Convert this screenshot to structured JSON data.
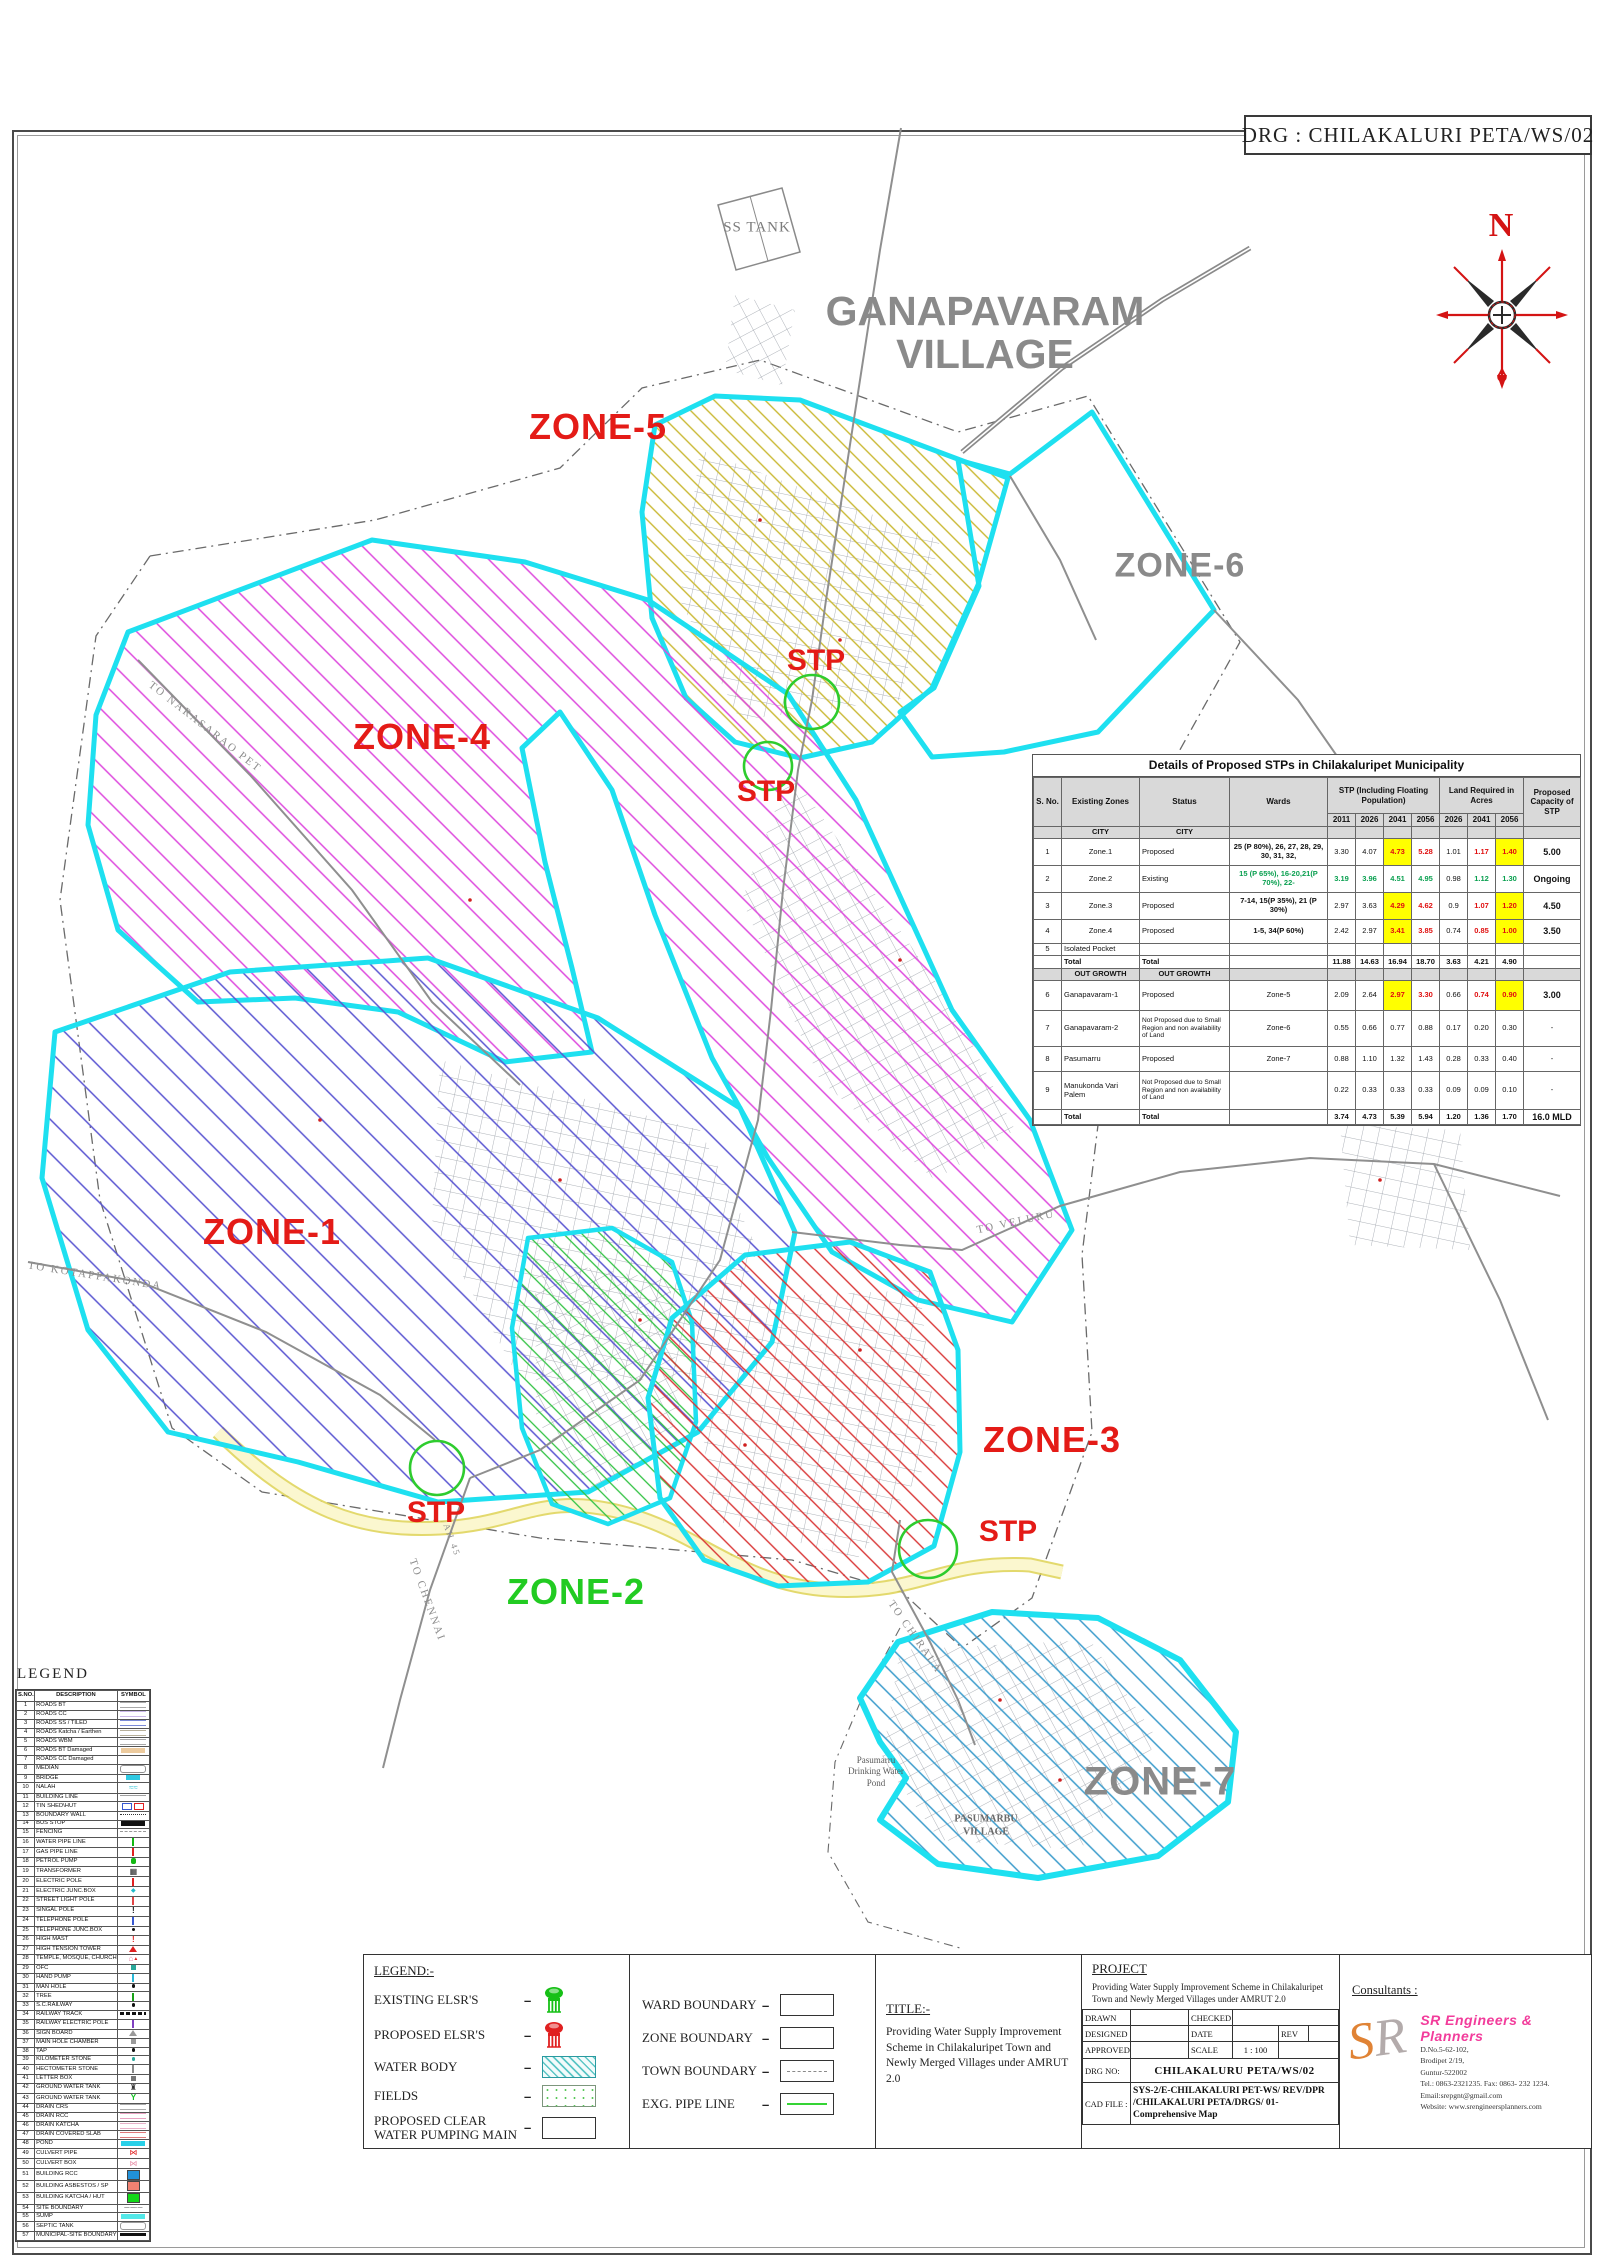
{
  "sheet": {
    "drg_title": "DRG : CHILAKALURI PETA/WS/02",
    "compass_n": "N"
  },
  "map": {
    "labels": {
      "ganapavaram_line1": "GANAPAVARAM",
      "ganapavaram_line2": "VILLAGE",
      "ss_tank": "SS TANK",
      "zone1": "ZONE-1",
      "zone2": "ZONE-2",
      "zone3": "ZONE-3",
      "zone4": "ZONE-4",
      "zone5": "ZONE-5",
      "zone6": "ZONE-6",
      "zone7": "ZONE-7",
      "stp": "STP",
      "pond_line1": "Pasumarru",
      "pond_line2": "Drinking Water",
      "pond_line3": "Pond",
      "pasumarbu_line1": "PASUMARBU",
      "pasumarbu_line2": "VILLAGE",
      "road_narasaraopet": "TO NARASARAO PET",
      "road_kotappakonda": "TO KOTAPPAKONDA",
      "road_veluru": "TO VELURU",
      "road_chennai": "TO CHENNAI",
      "road_chirala": "TO CHIRALA",
      "road_ah45": "AH 45"
    },
    "colors": {
      "zone_boundary": "#1ee0f0",
      "zone1_hatch": "#5a55d2",
      "zone2_hatch": "#30c242",
      "zone3_hatch": "#d93535",
      "zone4_hatch": "#de4ade",
      "zone5_hatch": "#c9b832",
      "zone7_hatch": "#3b9ccc",
      "stp_circle": "#2ecc2e",
      "label_red": "#e41b17",
      "label_gray": "#8a8a8a",
      "label_green": "#22cb22"
    }
  },
  "stp_table": {
    "title": "Details of Proposed STPs in Chilakaluripet Municipality",
    "col_headers": [
      "S. No.",
      "Existing Zones",
      "Status",
      "Wards"
    ],
    "group_stp": "STP (Including Floating Population)",
    "group_land": "Land Required in Acres",
    "group_capacity": "Proposed Capacity of STP",
    "years_stp": [
      "2011",
      "2026",
      "2041",
      "2056"
    ],
    "years_land": [
      "2026",
      "2041",
      "2056"
    ],
    "rows": [
      {
        "type": "section",
        "label": "CITY",
        "h": 12
      },
      {
        "type": "data",
        "h": 27,
        "cells": [
          {
            "t": "1"
          },
          {
            "t": "Zone.1"
          },
          {
            "t": "Proposed",
            "c": "lft"
          },
          {
            "t": "25 (P 80%), 26, 27, 28, 29, 30, 31, 32,",
            "c": "bold"
          },
          {
            "t": "3.30"
          },
          {
            "t": "4.07"
          },
          {
            "t": "4.73",
            "c": "hl"
          },
          {
            "t": "5.28",
            "c": "red"
          },
          {
            "t": "1.01"
          },
          {
            "t": "1.17",
            "c": "red"
          },
          {
            "t": "1.40",
            "c": "hl"
          },
          {
            "t": "5.00",
            "c": "cap"
          }
        ]
      },
      {
        "type": "data",
        "h": 27,
        "cells": [
          {
            "t": "2"
          },
          {
            "t": "Zone.2"
          },
          {
            "t": "Existing",
            "c": "lft"
          },
          {
            "t": "15 (P 65%), 16-20,21(P 70%), 22-",
            "c": "green"
          },
          {
            "t": "3.19",
            "c": "green"
          },
          {
            "t": "3.96",
            "c": "green"
          },
          {
            "t": "4.51",
            "c": "green"
          },
          {
            "t": "4.95",
            "c": "green"
          },
          {
            "t": "0.98"
          },
          {
            "t": "1.12",
            "c": "green"
          },
          {
            "t": "1.30",
            "c": "green"
          },
          {
            "t": "Ongoing",
            "c": "cap"
          }
        ]
      },
      {
        "type": "data",
        "h": 27,
        "cells": [
          {
            "t": "3"
          },
          {
            "t": "Zone.3"
          },
          {
            "t": "Proposed",
            "c": "lft"
          },
          {
            "t": "7-14, 15(P 35%), 21 (P 30%)",
            "c": "bold"
          },
          {
            "t": "2.97"
          },
          {
            "t": "3.63"
          },
          {
            "t": "4.29",
            "c": "hl"
          },
          {
            "t": "4.62",
            "c": "red"
          },
          {
            "t": "0.9"
          },
          {
            "t": "1.07",
            "c": "red"
          },
          {
            "t": "1.20",
            "c": "hl"
          },
          {
            "t": "4.50",
            "c": "cap"
          }
        ]
      },
      {
        "type": "data",
        "h": 24,
        "cells": [
          {
            "t": "4"
          },
          {
            "t": "Zone.4"
          },
          {
            "t": "Proposed",
            "c": "lft"
          },
          {
            "t": "1-5, 34(P 60%)",
            "c": "bold"
          },
          {
            "t": "2.42"
          },
          {
            "t": "2.97"
          },
          {
            "t": "3.41",
            "c": "hl"
          },
          {
            "t": "3.85",
            "c": "red"
          },
          {
            "t": "0.74"
          },
          {
            "t": "0.85",
            "c": "red"
          },
          {
            "t": "1.00",
            "c": "hl"
          },
          {
            "t": "3.50",
            "c": "cap"
          }
        ]
      },
      {
        "type": "data",
        "h": 12,
        "cells": [
          {
            "t": "5"
          },
          {
            "t": "Isolated Pocket",
            "c": "lft"
          },
          {
            "t": ""
          },
          {
            "t": ""
          },
          {
            "t": ""
          },
          {
            "t": ""
          },
          {
            "t": ""
          },
          {
            "t": ""
          },
          {
            "t": ""
          },
          {
            "t": ""
          },
          {
            "t": ""
          },
          {
            "t": ""
          }
        ]
      },
      {
        "type": "data",
        "h": 13,
        "cells": [
          {
            "t": ""
          },
          {
            "t": "Total",
            "c": "bold lft"
          },
          {
            "t": "Total",
            "c": "bold lft"
          },
          {
            "t": ""
          },
          {
            "t": "11.88",
            "c": "bold"
          },
          {
            "t": "14.63",
            "c": "bold"
          },
          {
            "t": "16.94",
            "c": "bold"
          },
          {
            "t": "18.70",
            "c": "bold"
          },
          {
            "t": "3.63",
            "c": "bold"
          },
          {
            "t": "4.21",
            "c": "bold"
          },
          {
            "t": "4.90",
            "c": "bold"
          },
          {
            "t": ""
          }
        ]
      },
      {
        "type": "section",
        "label": "OUT GROWTH",
        "h": 12
      },
      {
        "type": "data",
        "h": 30,
        "cells": [
          {
            "t": "6"
          },
          {
            "t": "Ganapavaram-1",
            "c": "lft"
          },
          {
            "t": "Proposed",
            "c": "lft"
          },
          {
            "t": "Zone-5"
          },
          {
            "t": "2.09"
          },
          {
            "t": "2.64"
          },
          {
            "t": "2.97",
            "c": "hl"
          },
          {
            "t": "3.30",
            "c": "red"
          },
          {
            "t": "0.66"
          },
          {
            "t": "0.74",
            "c": "red"
          },
          {
            "t": "0.90",
            "c": "hl"
          },
          {
            "t": "3.00",
            "c": "cap"
          }
        ]
      },
      {
        "type": "data",
        "h": 36,
        "cells": [
          {
            "t": "7"
          },
          {
            "t": "Ganapavaram-2",
            "c": "lft"
          },
          {
            "t": "Not Proposed due to Small Region and non availability of Land",
            "c": "tiny"
          },
          {
            "t": "Zone-6"
          },
          {
            "t": "0.55"
          },
          {
            "t": "0.66"
          },
          {
            "t": "0.77"
          },
          {
            "t": "0.88"
          },
          {
            "t": "0.17"
          },
          {
            "t": "0.20"
          },
          {
            "t": "0.30"
          },
          {
            "t": "-"
          }
        ]
      },
      {
        "type": "data",
        "h": 25,
        "cells": [
          {
            "t": "8"
          },
          {
            "t": "Pasumarru",
            "c": "lft"
          },
          {
            "t": "Proposed",
            "c": "lft"
          },
          {
            "t": "Zone-7"
          },
          {
            "t": "0.88"
          },
          {
            "t": "1.10"
          },
          {
            "t": "1.32"
          },
          {
            "t": "1.43"
          },
          {
            "t": "0.28"
          },
          {
            "t": "0.33"
          },
          {
            "t": "0.40"
          },
          {
            "t": "-"
          }
        ]
      },
      {
        "type": "data",
        "h": 38,
        "cells": [
          {
            "t": "9"
          },
          {
            "t": "Manukonda Vari Palem",
            "c": "lft"
          },
          {
            "t": "Not Proposed due to Small Region and non availability of Land",
            "c": "tiny"
          },
          {
            "t": ""
          },
          {
            "t": "0.22"
          },
          {
            "t": "0.33"
          },
          {
            "t": "0.33"
          },
          {
            "t": "0.33"
          },
          {
            "t": "0.09"
          },
          {
            "t": "0.09"
          },
          {
            "t": "0.10"
          },
          {
            "t": "-"
          }
        ]
      },
      {
        "type": "data",
        "h": 15,
        "cells": [
          {
            "t": ""
          },
          {
            "t": "Total",
            "c": "bold lft"
          },
          {
            "t": "Total",
            "c": "bold lft"
          },
          {
            "t": ""
          },
          {
            "t": "3.74",
            "c": "bold"
          },
          {
            "t": "4.73",
            "c": "bold"
          },
          {
            "t": "5.39",
            "c": "bold"
          },
          {
            "t": "5.94",
            "c": "bold"
          },
          {
            "t": "1.20",
            "c": "bold"
          },
          {
            "t": "1.36",
            "c": "bold"
          },
          {
            "t": "1.70",
            "c": "bold"
          },
          {
            "t": "16.0 MLD",
            "c": "cap"
          }
        ]
      }
    ]
  },
  "legend_table": {
    "title": "LEGEND",
    "headers": [
      "S.NO.",
      "DESCRIPTION",
      "SYMBOL"
    ],
    "rows": [
      {
        "n": "1",
        "d": "ROADS BT",
        "k": "lines",
        "c": "#a8a8a8"
      },
      {
        "n": "2",
        "d": "ROADS CC",
        "k": "lines",
        "c": "#cbb8e8"
      },
      {
        "n": "3",
        "d": "ROADS SS / TILED",
        "k": "lines",
        "c": "#7b8bd8"
      },
      {
        "n": "4",
        "d": "ROADS Katcha / Earthen",
        "k": "lines",
        "c": "#b8b09a"
      },
      {
        "n": "5",
        "d": "ROADS WBM",
        "k": "lines",
        "c": "#a8a8a8"
      },
      {
        "n": "6",
        "d": "ROADS BT Damaged",
        "k": "bar",
        "c": "#edcb9e"
      },
      {
        "n": "7",
        "d": "ROADS CC Damaged",
        "k": "blank",
        "c": "#ffffff"
      },
      {
        "n": "8",
        "d": "MEDIAN",
        "k": "pill",
        "c": "#909090"
      },
      {
        "n": "9",
        "d": "BRIDGE",
        "k": "barsm",
        "c": "#2fc9e2"
      },
      {
        "n": "10",
        "d": "NALAH",
        "k": "nalah",
        "c": "#3fc9da"
      },
      {
        "n": "11",
        "d": "BUILDING LINE",
        "k": "line",
        "c": "#a0a0a0"
      },
      {
        "n": "12",
        "d": "TIN SHED\\HUT",
        "k": "tinshed",
        "c": "#3858d0"
      },
      {
        "n": "13",
        "d": "BOUNDARY WALL",
        "k": "dots",
        "c": "#333333"
      },
      {
        "n": "14",
        "d": "BUS STOP",
        "k": "bar",
        "c": "#111111"
      },
      {
        "n": "15",
        "d": "FENCING",
        "k": "dash",
        "c": "#999999"
      },
      {
        "n": "16",
        "d": "WATER PIPE LINE",
        "k": "tick",
        "c": "#12b812"
      },
      {
        "n": "17",
        "d": "GAS PIPE LINE",
        "k": "tick",
        "c": "#e02020"
      },
      {
        "n": "18",
        "d": "PETROL PUMP",
        "k": "blob",
        "c": "#12b812"
      },
      {
        "n": "19",
        "d": "TRANSFORMER",
        "k": "transformer",
        "c": "#222222"
      },
      {
        "n": "20",
        "d": "ELECTRIC POLE",
        "k": "tick",
        "c": "#e02020"
      },
      {
        "n": "21",
        "d": "ELECTRIC JUNC.BOX",
        "k": "junc",
        "c": "#21b9c9"
      },
      {
        "n": "22",
        "d": "STREET LIGHT POLE",
        "k": "tick",
        "c": "#e04545"
      },
      {
        "n": "23",
        "d": "SINGAL POLE",
        "k": "excl",
        "c": "#111111"
      },
      {
        "n": "24",
        "d": "TELEPHONE POLE",
        "k": "tick",
        "c": "#3858d0"
      },
      {
        "n": "25",
        "d": "TELEPHONE JUNC.BOX",
        "k": "dot",
        "c": "#111111"
      },
      {
        "n": "26",
        "d": "HIGH MAST",
        "k": "excl",
        "c": "#e02020"
      },
      {
        "n": "27",
        "d": "HIGH TENSION TOWER",
        "k": "tri",
        "c": "#e02020"
      },
      {
        "n": "28",
        "d": "TEMPLE, MOSQUE, CHURCH",
        "k": "temple",
        "c": "#e87fa8"
      },
      {
        "n": "29",
        "d": "OFC",
        "k": "sq",
        "c": "#2aa89a"
      },
      {
        "n": "30",
        "d": "HAND PUMP",
        "k": "tick",
        "c": "#28b8d8"
      },
      {
        "n": "31",
        "d": "MAN HOLE",
        "k": "dot",
        "c": "#111111"
      },
      {
        "n": "32",
        "d": "TREE",
        "k": "tick",
        "c": "#18a018"
      },
      {
        "n": "33",
        "d": "S.C.RAILWAY",
        "k": "dot",
        "c": "#111111"
      },
      {
        "n": "34",
        "d": "RAILWAY TRACK",
        "k": "rail",
        "c": "#111111"
      },
      {
        "n": "35",
        "d": "RAILWAY ELECTRIC POLE",
        "k": "tick",
        "c": "#8040c0"
      },
      {
        "n": "36",
        "d": "SIGN BOARD",
        "k": "tri",
        "c": "#9a9a9a"
      },
      {
        "n": "37",
        "d": "MAIN HOLE CHAMBER",
        "k": "sq",
        "c": "#9a9a9a"
      },
      {
        "n": "38",
        "d": "TAP",
        "k": "dot",
        "c": "#111111"
      },
      {
        "n": "39",
        "d": "KILOMETER STONE",
        "k": "dot",
        "c": "#2aa89a"
      },
      {
        "n": "40",
        "d": "HECTOMETER STONE",
        "k": "tick",
        "c": "#8a8a8a"
      },
      {
        "n": "41",
        "d": "LETTER BOX",
        "k": "sq",
        "c": "#787878"
      },
      {
        "n": "42",
        "d": "GROUND WATER TANK",
        "k": "tank",
        "c": "#333333"
      },
      {
        "n": "43",
        "d": "GROUND WATER TANK",
        "k": "y",
        "c": "#12c020"
      },
      {
        "n": "44",
        "d": "DRAIN CRS",
        "k": "lines",
        "c": "#ababab"
      },
      {
        "n": "45",
        "d": "DRAIN RCC",
        "k": "lines",
        "c": "#e8a2c2"
      },
      {
        "n": "46",
        "d": "DRAIN KATCHA",
        "k": "lines",
        "c": "#e8b2ca"
      },
      {
        "n": "47",
        "d": "DRAIN COVERED SLAB",
        "k": "lines",
        "c": "#e07a7a"
      },
      {
        "n": "48",
        "d": "POND",
        "k": "bar",
        "c": "#28d0e8"
      },
      {
        "n": "49",
        "d": "CULVERT PIPE",
        "k": "culvert",
        "c": "#e02020"
      },
      {
        "n": "50",
        "d": "CULVERT BOX",
        "k": "culvert",
        "c": "#e892aa"
      },
      {
        "n": "51",
        "d": "BUILDING RCC",
        "k": "rect",
        "c": "#2191d9"
      },
      {
        "n": "52",
        "d": "BUILDING ASBESTOS / SP",
        "k": "rect",
        "c": "#f08272"
      },
      {
        "n": "53",
        "d": "BUILDING KATCHA / HUT",
        "k": "rect",
        "c": "#12d818"
      },
      {
        "n": "54",
        "d": "SITE BOUNDARY",
        "k": "dashdot",
        "c": "#111111"
      },
      {
        "n": "55",
        "d": "SUMP",
        "k": "bar",
        "c": "#52e8e8"
      },
      {
        "n": "56",
        "d": "SEPTIC TANK",
        "k": "pill",
        "c": "#9a9a9a"
      },
      {
        "n": "57",
        "d": "MUNICIPAL-SITE BOUNDARY",
        "k": "thick",
        "c": "#111111"
      }
    ]
  },
  "titleblock": {
    "legend_heading": "LEGEND:-",
    "legend_items": [
      {
        "label": "EXISTING ELSR'S",
        "icon": "elsr-green"
      },
      {
        "label": "PROPOSED ELSR'S",
        "icon": "elsr-red"
      },
      {
        "label": "WATER BODY",
        "icon": "waterbody"
      },
      {
        "label": "FIELDS",
        "icon": "fields"
      },
      {
        "label": "PROPOSED CLEAR WATER PUMPING MAIN",
        "icon": "box"
      }
    ],
    "boundary_items": [
      {
        "label": "WARD BOUNDARY",
        "icon": "box"
      },
      {
        "label": "ZONE BOUNDARY",
        "icon": "box"
      },
      {
        "label": "TOWN BOUNDARY",
        "icon": "box-dashed"
      },
      {
        "label": "EXG. PIPE LINE",
        "icon": "box-greenline"
      }
    ],
    "title_heading": "TITLE:-",
    "title_text": "Providing Water Supply Improvement Scheme in Chilakaluripet Town and Newly Merged Villages under AMRUT 2.0",
    "project_heading": "PROJECT",
    "project_text": "Providing Water Supply Improvement Scheme in Chilakaluripet Town and Newly Merged Villages under AMRUT 2.0",
    "fields": {
      "drawn": "DRAWN",
      "checked": "CHECKED",
      "designed": "DESIGNED",
      "date": "DATE",
      "rev": "REV",
      "approved": "APPROVED",
      "scale": "SCALE",
      "scale_value": "1 : 100",
      "drg_no_label": "DRG NO:",
      "drg_no_value": "CHILAKALURU PETA/WS/02",
      "cad_file_label": "CAD FILE :",
      "cad_file_value": "SYS-2/E-CHILAKALURI PET-WS/ REV/DPR /CHILAKALURI PETA/DRGS/ 01-Comprehensive Map"
    },
    "consultants": {
      "heading": "Consultants :",
      "logo_s": "S",
      "logo_r": "R",
      "name": "SR Engineers & Planners",
      "lines": [
        "D.No.5-62-102,",
        "Brodipet 2/19,",
        "Guntur-522002",
        "Tel.: 0863-2321235. Fax: 0863- 232 1234.",
        "Email:srepgnt@gmail.com",
        "Website: www.srengineersplanners.com"
      ]
    }
  }
}
